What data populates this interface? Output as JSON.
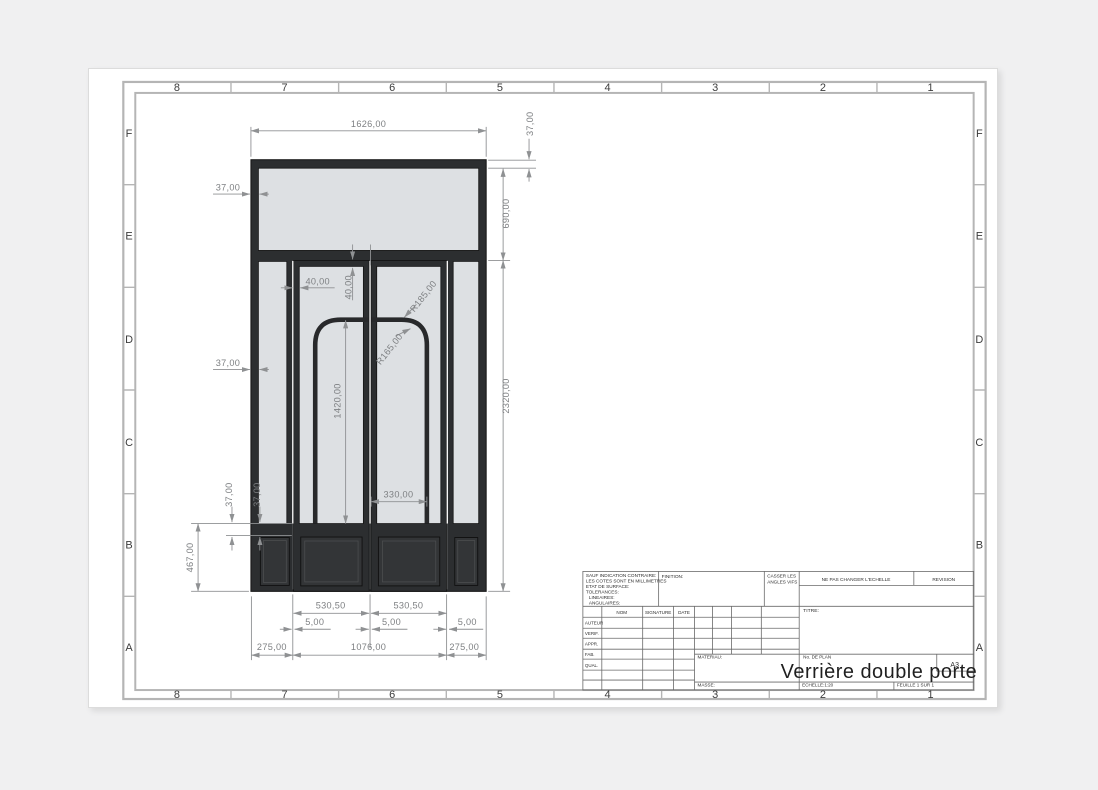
{
  "sheet": {
    "zones_cols": [
      "8",
      "7",
      "6",
      "5",
      "4",
      "3",
      "2",
      "1"
    ],
    "zones_rows": [
      "F",
      "E",
      "D",
      "C",
      "B",
      "A"
    ]
  },
  "title_block": {
    "notes": [
      "SAUF INDICATION CONTRAIRE:",
      "LES COTES SONT EN MILLIMETRES",
      "ETAT DE SURFACE:",
      "TOLERANCES:",
      "LINEAIRES:",
      "ANGULAIRES:"
    ],
    "finition_label": "FINITION:",
    "deburr_line1": "CASSER LES",
    "deburr_line2": "ANGLES VIFS",
    "no_scale_label": "NE PAS CHANGER L'ECHELLE",
    "revision_label": "REVISION",
    "nom": "NOM",
    "signature": "SIGNATURE",
    "date": "DATE",
    "rows": [
      "AUTEUR",
      "VERIF.",
      "APPR.",
      "FAB.",
      "QUAL."
    ],
    "titre_label": "TITRE:",
    "materiau_label": "MATERIAU:",
    "masse_label": "MASSE:",
    "plan_label": "No. DE PLAN",
    "paper_size": "A3",
    "echelle": "ECHELLE:1:20",
    "feuille": "FEUILLE 1 SUR 1",
    "title": "Verrière double porte"
  },
  "dimensions": {
    "overall_width": "1626,00",
    "top_bar": "37,00",
    "transom_height": "690,00",
    "lower_height": "2320,00",
    "frame_left_top": "37,00",
    "frame_left_mid": "37,00",
    "kick_rail_a": "37,00",
    "kick_rail_b": "37,00",
    "kick_height": "467,00",
    "stile_width": "40,00",
    "rail_height": "40,00",
    "arch_height": "1420,00",
    "arch_width": "330,00",
    "radius_inner": "R165,00",
    "radius_outer": "R185,00",
    "door_width_left": "530,50",
    "door_width_right": "530,50",
    "gap_left": "5,00",
    "gap_center": "5,00",
    "gap_right": "5,00",
    "left_module": "275,00",
    "doors_total": "1076,00",
    "right_module": "275,00"
  },
  "colors": {
    "frame_dark": "#2c2e30",
    "panel_fill": "#333537",
    "glass": "#dde0e3",
    "dimension_gray": "#8f9193",
    "border_gray": "#b5b5b5"
  }
}
